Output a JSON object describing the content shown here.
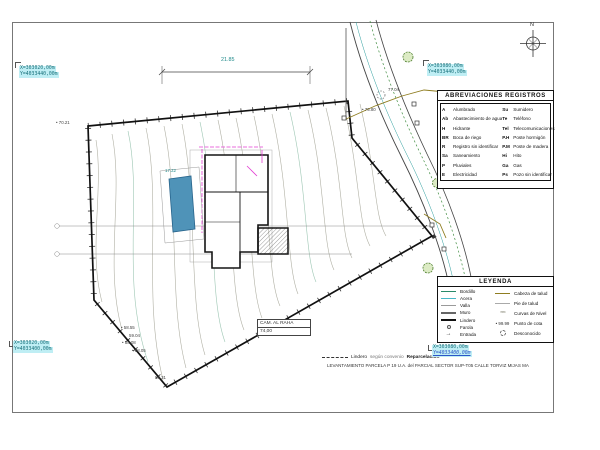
{
  "north": {
    "label": "N"
  },
  "dimension": {
    "value": "21.85"
  },
  "coordinates": {
    "top_left": {
      "x": "X=303020,00m",
      "y": "Y=4033440,00m"
    },
    "top_right": {
      "x": "X=303080,00m",
      "y": "Y=4033440,00m"
    },
    "bottom_left": {
      "x": "X=303020,00m",
      "y": "Y=4033400,00m"
    },
    "bottom_right": {
      "x": "X=303080,00m",
      "y": "Y=4033400,00m"
    }
  },
  "abbreviations": {
    "title": "ABREVIACIONES REGISTROS",
    "left": [
      {
        "abbr": "A",
        "name": "Alumbrado"
      },
      {
        "abbr": "Ab",
        "name": "Abastecimiento de agua"
      },
      {
        "abbr": "H",
        "name": "Hidrante"
      },
      {
        "abbr": "BR",
        "name": "Boca de riego"
      },
      {
        "abbr": "R",
        "name": "Registro sin identificar"
      },
      {
        "abbr": "Sa",
        "name": "Saneamiento"
      },
      {
        "abbr": "P",
        "name": "Pluviales"
      },
      {
        "abbr": "E",
        "name": "Electricidad"
      }
    ],
    "right": [
      {
        "abbr": "Su",
        "name": "Sumidero"
      },
      {
        "abbr": "Te",
        "name": "Teléfono"
      },
      {
        "abbr": "Tel",
        "name": "Telecomunicaciones"
      },
      {
        "abbr": "P.H",
        "name": "Poste hormigón"
      },
      {
        "abbr": "P.M",
        "name": "Poste de madera"
      },
      {
        "abbr": "Hi",
        "name": "Hito"
      },
      {
        "abbr": "Ga",
        "name": "Gas"
      },
      {
        "abbr": "Ps",
        "name": "Pozo sin identificar"
      }
    ]
  },
  "legend": {
    "title": "LEYENDA",
    "left": [
      {
        "label": "Bordillo",
        "sample": "line",
        "color": "#2a8a6a"
      },
      {
        "label": "Acera",
        "sample": "line",
        "color": "#49b8c8"
      },
      {
        "label": "Valla",
        "sample": "line",
        "color": "#9a9a9a"
      },
      {
        "label": "Muro",
        "sample": "line-thick",
        "color": "#666666"
      },
      {
        "label": "Lindero",
        "sample": "line-thick",
        "color": "#111111"
      },
      {
        "label": "Farola",
        "sample": "circle",
        "color": "#555555"
      },
      {
        "label": "Entrada",
        "sample": "arrow",
        "color": "#333333"
      }
    ],
    "right": [
      {
        "label": "Cabeza de talud",
        "sample": "line",
        "color": "#8f7d20"
      },
      {
        "label": "Pie de talud",
        "sample": "line",
        "color": "#aaaaaa"
      },
      {
        "label": "Curvas de Nivel",
        "sample": "wavy",
        "color": "#888877"
      },
      {
        "label": "Punto de cota",
        "sample": "dot-value",
        "color": "#333333",
        "value": "99.99"
      },
      {
        "label": "Desconocido",
        "sample": "dashed-circle",
        "color": "#666666"
      }
    ]
  },
  "name_box": {
    "line1": "CAM. AL RAHA",
    "line2": "74,00"
  },
  "footer": {
    "lindero_label": "Lindero",
    "lindero_note": "según convenio",
    "lindero_bold": "Reparcelación",
    "title_line": "LEVANTAMIENTO PARCELA P 19 U.A. del PARCIAL SECTOR SUP-T05 CALLE TORVIZ MIJAS MA"
  },
  "spot_elevations": [
    {
      "value": "70.21",
      "x": 56,
      "y": 120,
      "dot": true,
      "teal": false
    },
    {
      "value": "77.04",
      "x": 388,
      "y": 87,
      "dot": false,
      "teal": false
    },
    {
      "value": "75.80",
      "x": 362,
      "y": 107,
      "dot": true,
      "teal": false
    },
    {
      "value": "17.22",
      "x": 165,
      "y": 168,
      "dot": false,
      "teal": true
    },
    {
      "value": "58.55",
      "x": 121,
      "y": 325,
      "dot": true,
      "teal": false
    },
    {
      "value": "59.04",
      "x": 129,
      "y": 333,
      "dot": false,
      "teal": false
    },
    {
      "value": "58.08",
      "x": 122,
      "y": 340,
      "dot": true,
      "teal": false
    },
    {
      "value": "58.05",
      "x": 132,
      "y": 348,
      "dot": true,
      "teal": false
    },
    {
      "value": "58.31",
      "x": 155,
      "y": 375,
      "dot": false,
      "teal": false
    }
  ],
  "colors": {
    "highlight": "#bfeef4",
    "coord_text": "#17707a",
    "magenta": "#e23ed2",
    "pool": "#4f93b8",
    "contour": "#b0b0a4",
    "road_green": "#3d8b3d",
    "olive": "#8f7d20",
    "teal": "#2a9d9d"
  }
}
